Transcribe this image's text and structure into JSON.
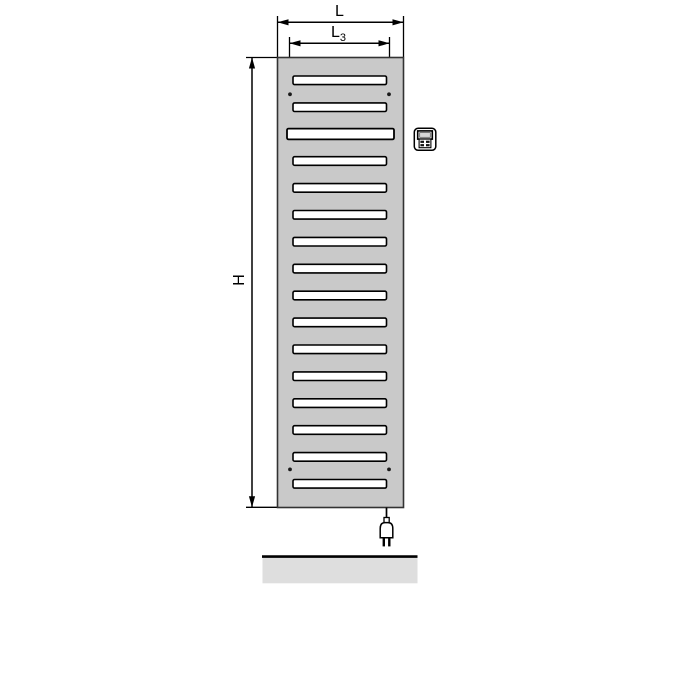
{
  "diagram": {
    "kind": "radiator-technical-drawing",
    "dimension_labels": {
      "width": "L",
      "mounting_width_base": "L",
      "mounting_width_sub": "3",
      "height": "H"
    },
    "radiator": {
      "slot_count": 16,
      "wide_slot_index": 2,
      "mounting_screw_count": 4
    },
    "icons": {
      "control_unit": "control-unit-icon",
      "power_plug": "power-plug-icon"
    },
    "colors": {
      "body": "#c9c9c9",
      "outline": "#333333",
      "slot_fill": "#ffffff",
      "line": "#000000",
      "screen": "#d8d8d8",
      "floor_strip": "#dedede",
      "background": "#ffffff"
    }
  }
}
